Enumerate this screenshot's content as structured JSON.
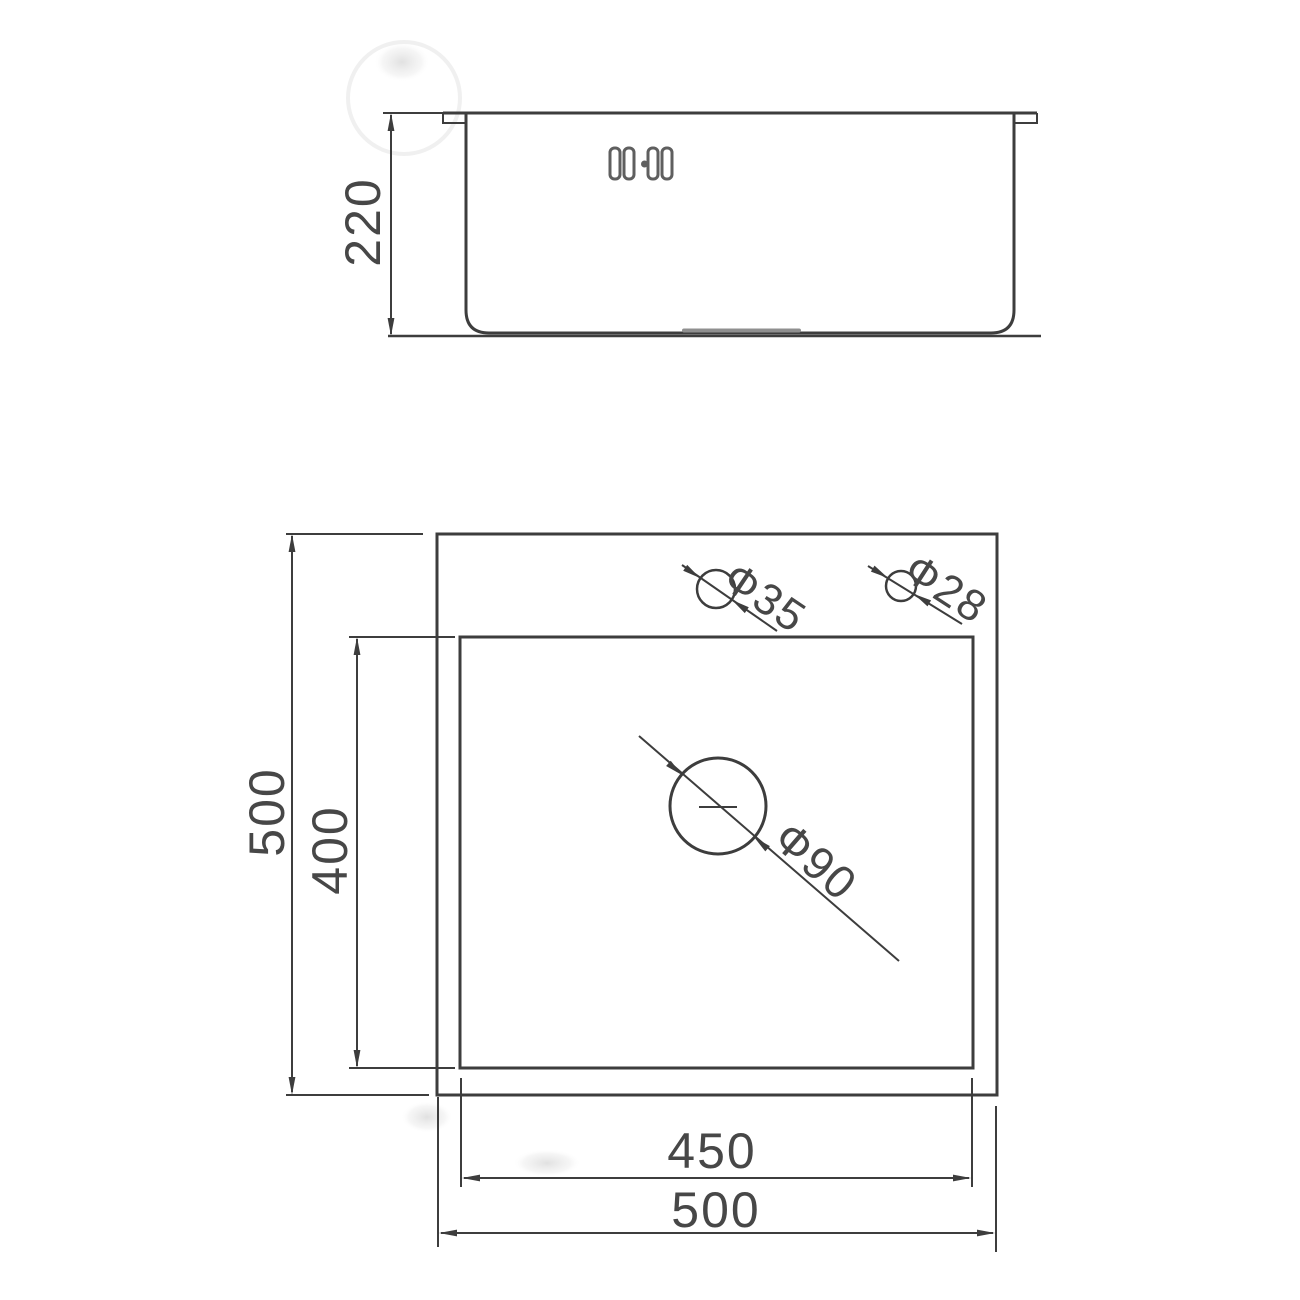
{
  "drawing": {
    "subject": "sink-technical-drawing",
    "side_view": {
      "height_dim": "220"
    },
    "plan_view": {
      "outer_height_dim": "500",
      "inner_depth_dim": "400",
      "inner_width_dim": "450",
      "outer_width_dim": "500",
      "hole_faucet_dim": "Ф35",
      "hole_aux_dim": "Ф28",
      "hole_drain_dim": "Ф90"
    },
    "colors": {
      "line": "#3d3d3d",
      "text": "#474747",
      "light_line": "#8f8f8f",
      "background": "#ffffff"
    }
  }
}
